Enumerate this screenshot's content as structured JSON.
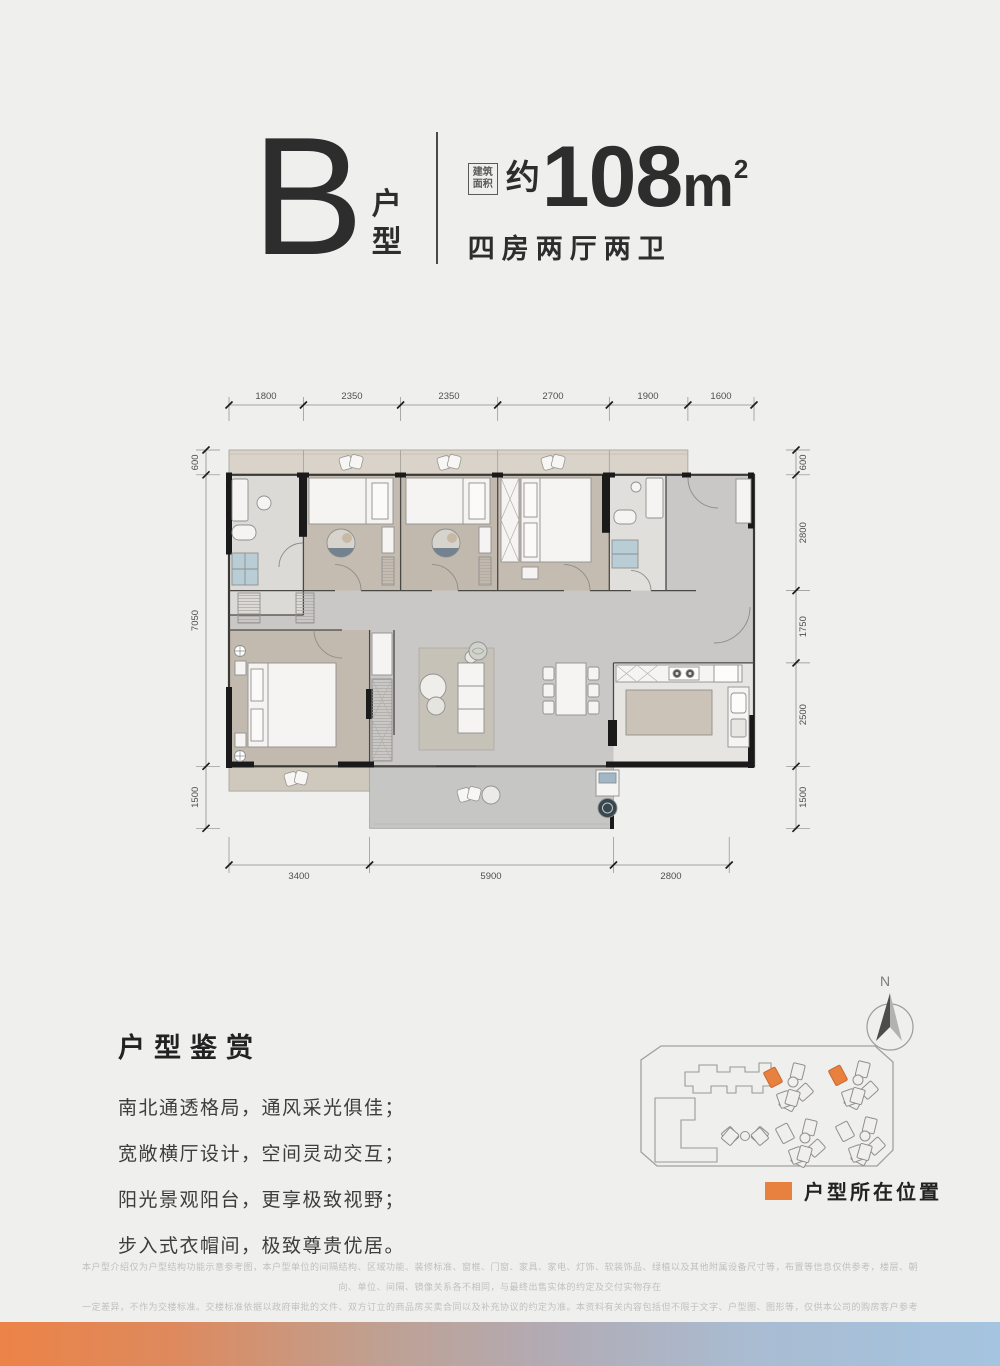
{
  "header": {
    "letter": "B",
    "type_char_1": "户",
    "type_char_2": "型",
    "area_box_line1": "建筑",
    "area_box_line2": "面积",
    "approx": "约",
    "area_value": "108",
    "area_unit": "m",
    "area_sup": "2",
    "subtitle": "四房两厅两卫"
  },
  "floorplan": {
    "dims_top": [
      "1800",
      "2350",
      "2350",
      "2700",
      "1900",
      "1600"
    ],
    "dims_left": [
      "600",
      "7050",
      "1500"
    ],
    "dims_right": [
      "600",
      "2800",
      "1750",
      "2500",
      "1500"
    ],
    "dims_bottom": [
      "3400",
      "5900",
      "2800"
    ]
  },
  "appreciation": {
    "title": "户型鉴赏",
    "lines": [
      "南北通透格局，通风采光俱佳；",
      "宽敞横厅设计，空间灵动交互；",
      "阳光景观阳台，更享极致视野；",
      "步入式衣帽间，极致尊贵优居。"
    ]
  },
  "siteplan": {
    "compass_label": "N",
    "legend_label": "户型所在位置",
    "highlight_color": "#E8813F"
  },
  "disclaimer": {
    "lines": [
      "本户型介绍仅为户型结构功能示意参考图，本户型单位的间隔结构、区域功能、装修标准、窗框、门窗、家具、家电、灯饰、软装饰品、绿植以及其他附属设备尺寸等，布置等信息仅供参考，楼层、朝向、单位、间隔、镜像关系各不相同，与最终出售实体的约定及交付实物存在",
      "一定差异，不作为交楼标准。交楼标准依据以政府审批的文件、双方订立的商品房买卖合同以及补充协议的约定为准。本资料有关内容包括但不限于文字、户型图、图形等，仅供本公司的购房客户参考使用，参考使用，亦非最终权利义务或确定性意思表达的法律文书，",
      "尽量做到本资料的信息真实准确，如有信息调整的内容，最终解释权归开发商所有。本资料制作时间2023年6月。"
    ]
  },
  "colors": {
    "accent": "#E8813F"
  }
}
